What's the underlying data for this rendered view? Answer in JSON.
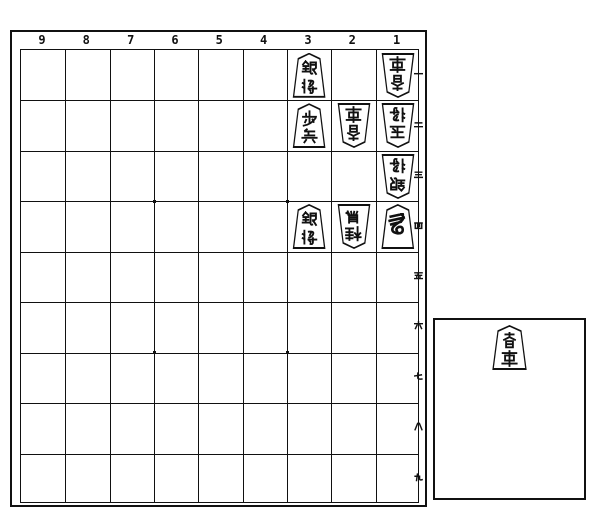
{
  "board": {
    "file_labels": [
      "9",
      "8",
      "7",
      "6",
      "5",
      "4",
      "3",
      "2",
      "1"
    ],
    "rank_labels": [
      "一",
      "二",
      "三",
      "四",
      "五",
      "六",
      "七",
      "八",
      "九"
    ],
    "star_points": 4,
    "pieces": [
      {
        "square": "3一",
        "file": 3,
        "rank": 1,
        "side": "sente",
        "name": "銀将",
        "piece": "silver-general",
        "cursive": false
      },
      {
        "square": "1一",
        "file": 1,
        "rank": 1,
        "side": "gote",
        "name": "香車",
        "piece": "lance",
        "cursive": false
      },
      {
        "square": "3二",
        "file": 3,
        "rank": 2,
        "side": "sente",
        "name": "歩兵",
        "piece": "pawn",
        "cursive": false
      },
      {
        "square": "2二",
        "file": 2,
        "rank": 2,
        "side": "gote",
        "name": "香車",
        "piece": "lance",
        "cursive": false
      },
      {
        "square": "1二",
        "file": 1,
        "rank": 2,
        "side": "gote",
        "name": "玉将",
        "piece": "king",
        "cursive": false
      },
      {
        "square": "1三",
        "file": 1,
        "rank": 3,
        "side": "gote",
        "name": "銀将",
        "piece": "silver-general",
        "cursive": false
      },
      {
        "square": "3四",
        "file": 3,
        "rank": 4,
        "side": "sente",
        "name": "銀将",
        "piece": "silver-general",
        "cursive": false
      },
      {
        "square": "2四",
        "file": 2,
        "rank": 4,
        "side": "gote",
        "name": "桂馬",
        "piece": "knight",
        "cursive": false
      },
      {
        "square": "1四",
        "file": 1,
        "rank": 4,
        "side": "sente",
        "name": "馬",
        "piece": "promoted-bishop",
        "cursive": true
      }
    ]
  },
  "hand_box": {
    "owner": "sente",
    "pieces": [
      {
        "name": "香車",
        "piece": "lance",
        "side": "sente",
        "cursive": false
      }
    ]
  },
  "colors": {
    "ink": "#111111",
    "paper": "#ffffff"
  }
}
